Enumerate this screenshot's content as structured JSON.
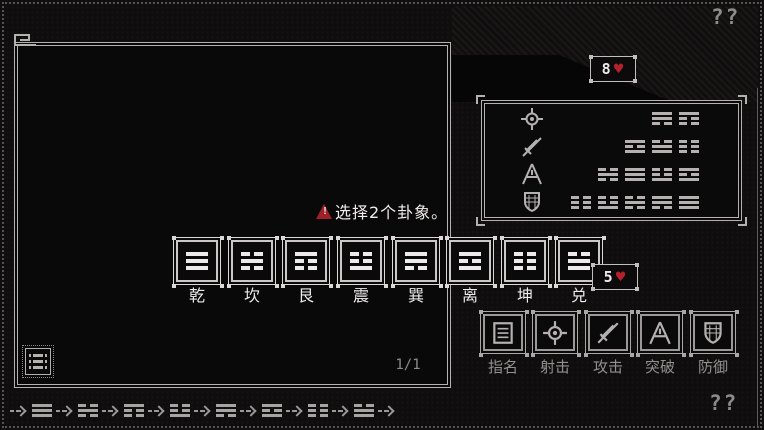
{
  "hud": {
    "top_right_mark": "??",
    "bottom_right_mark": "??",
    "enemy_health": {
      "value": "8",
      "heart": "♥"
    },
    "player_health": {
      "value": "5",
      "heart": "♥"
    }
  },
  "warning": {
    "text": "选择2个卦象。"
  },
  "page_indicator": "1/1",
  "trigram_buttons": [
    {
      "label": "乾",
      "lines": [
        1,
        1,
        1
      ]
    },
    {
      "label": "坎",
      "lines": [
        0,
        1,
        0
      ]
    },
    {
      "label": "艮",
      "lines": [
        1,
        0,
        0
      ]
    },
    {
      "label": "震",
      "lines": [
        0,
        0,
        1
      ]
    },
    {
      "label": "巽",
      "lines": [
        1,
        1,
        0
      ]
    },
    {
      "label": "离",
      "lines": [
        1,
        0,
        1
      ]
    },
    {
      "label": "坤",
      "lines": [
        0,
        0,
        0
      ]
    },
    {
      "label": "兑",
      "lines": [
        0,
        1,
        1
      ]
    }
  ],
  "combo_panel": {
    "rows": [
      {
        "icon": "crosshair-icon",
        "trigrams": [
          [
            1,
            1,
            0
          ],
          [
            1,
            0,
            0
          ]
        ]
      },
      {
        "icon": "sword-icon",
        "trigrams": [
          [
            1,
            0,
            1
          ],
          [
            0,
            1,
            1
          ],
          [
            0,
            0,
            0
          ]
        ]
      },
      {
        "icon": "breakthrough-icon",
        "trigrams": [
          [
            0,
            1,
            0
          ],
          [
            1,
            1,
            1
          ],
          [
            0,
            0,
            1
          ],
          [
            1,
            0,
            1
          ]
        ]
      },
      {
        "icon": "shield-icon",
        "trigrams": [
          [
            0,
            0,
            0
          ],
          [
            0,
            0,
            1
          ],
          [
            0,
            1,
            0
          ],
          [
            1,
            1,
            0
          ],
          [
            1,
            1,
            1
          ]
        ]
      }
    ]
  },
  "action_bar": [
    {
      "label": "指名",
      "icon": "name-list-icon"
    },
    {
      "label": "射击",
      "icon": "crosshair-icon"
    },
    {
      "label": "攻击",
      "icon": "sword-icon"
    },
    {
      "label": "突破",
      "icon": "breakthrough-icon"
    },
    {
      "label": "防御",
      "icon": "shield-icon"
    }
  ],
  "sequence_bar": {
    "trigrams": [
      [
        1,
        1,
        1
      ],
      [
        0,
        1,
        0
      ],
      [
        1,
        0,
        0
      ],
      [
        0,
        0,
        1
      ],
      [
        1,
        1,
        0
      ],
      [
        1,
        0,
        1
      ],
      [
        0,
        0,
        0
      ],
      [
        0,
        1,
        1
      ]
    ]
  },
  "colors": {
    "accent_red": "#b1222c",
    "frame_light": "#c9c5c5",
    "text_gray": "#9a9696",
    "background": "#0f0d0d"
  }
}
